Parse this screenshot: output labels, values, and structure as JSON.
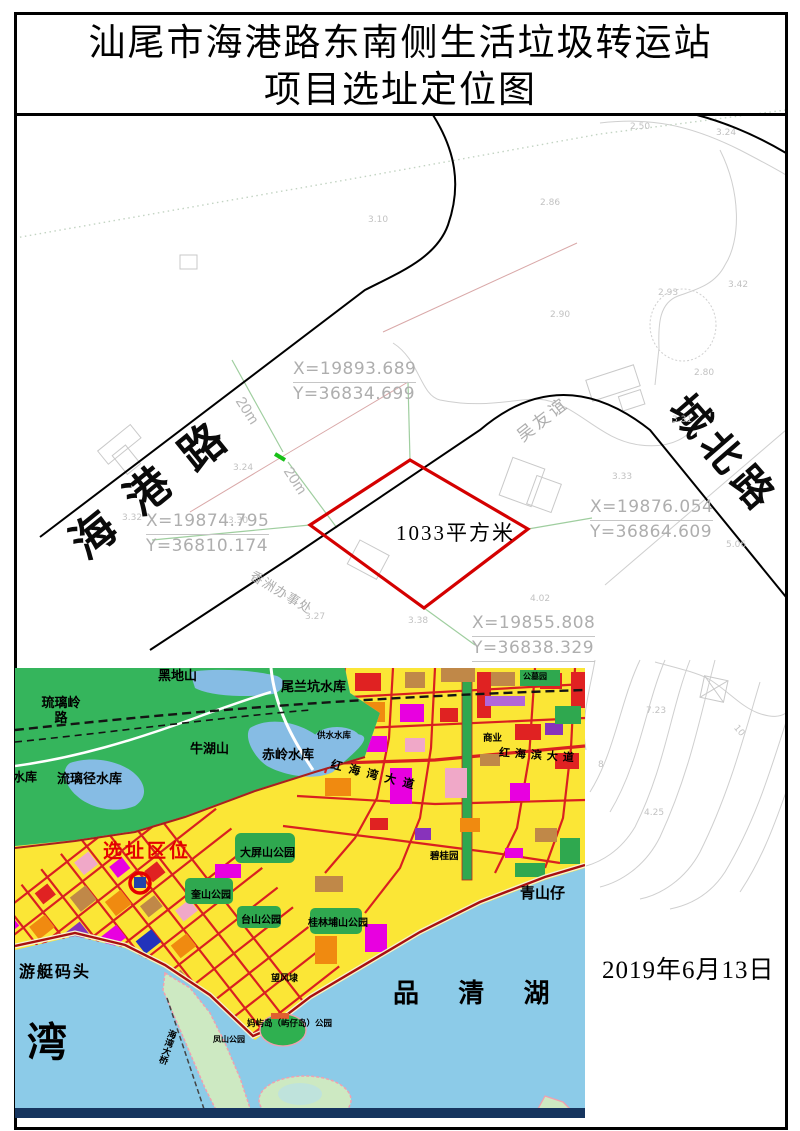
{
  "title": {
    "line1": "汕尾市海港路东南侧生活垃圾转运站",
    "line2": "项目选址定位图"
  },
  "date_label": "2019年6月13日",
  "site_plan": {
    "road_left": "海港路",
    "road_right": "城北路",
    "neighbor_label": "吴友谊",
    "office_label": "香洲办事处",
    "parcel_area": "1033平方米",
    "parcel_color": "#d40000",
    "dim_labels": [
      "20m",
      "20m"
    ],
    "coords": [
      {
        "x": "X=19893.689",
        "y": "Y=36834.699"
      },
      {
        "x": "X=19874.795",
        "y": "Y=36810.174"
      },
      {
        "x": "X=19876.054",
        "y": "Y=36864.609"
      },
      {
        "x": "X=19855.808",
        "y": "Y=36838.329"
      }
    ],
    "spot_elevations": [
      "2.50",
      "3.24",
      "3.10",
      "2.86",
      "2.90",
      "2.93",
      "3.42",
      "3.24",
      "3.31",
      "3.33",
      "2.80",
      "5.06",
      "3.30",
      "3.32",
      "3.27",
      "3.38",
      "4.02",
      "7.23",
      "4.25",
      "10",
      "8"
    ]
  },
  "inset_map": {
    "site_marker": "选址区位",
    "labels": {
      "heidishan": "黑地山",
      "weilankeng": "尾兰坑水库",
      "liuliling": "琉璃岭路",
      "niuhushan": "牛湖山",
      "chiling": "赤岭水库",
      "gongshui": "供水水库",
      "liulijing": "流璃径水库",
      "shuiku": "水库",
      "gongmu": "公墓园",
      "shangye": "商业",
      "dadao1": "红海湾大道",
      "dadao2": "红海滨大道",
      "dapingshan": "大屏山公园",
      "kuishan": "奎山公园",
      "taishan": "台山公园",
      "guilinpu": "桂林埔山公园",
      "biguiyuan": "碧桂园",
      "qingshanzai": "青山仔",
      "wangfengdai": "望风埭",
      "youtingmatou": "游艇码头",
      "fengshan": "凤山公园",
      "yuzaidao": "妈屿岛（屿仔岛）公园",
      "bridge": "海湾大桥",
      "pinqinghu": "品 清 湖",
      "wan": "湾"
    }
  }
}
